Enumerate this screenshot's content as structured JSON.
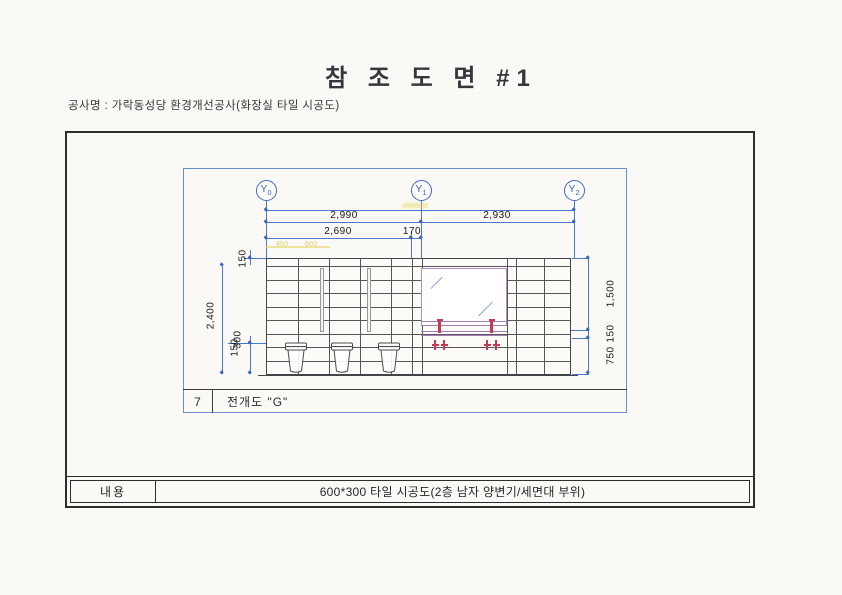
{
  "header": {
    "title": "참 조 도 면 #1",
    "project": "공사명 : 가락동성당 환경개선공사(화장실 타일 시공도)"
  },
  "drawing": {
    "markers": [
      {
        "base": "Y",
        "sub": "0"
      },
      {
        "base": "Y",
        "sub": "1"
      },
      {
        "base": "Y",
        "sub": "2"
      }
    ],
    "dims": {
      "span_left": "2,990",
      "span_right": "2,930",
      "sub_span": "2,690",
      "wall_thickness": "170",
      "left_top": "150",
      "left_height": "2,400",
      "left_bottom_upper": "300",
      "left_bottom_lower": "150",
      "right_upper": "1,500",
      "right_mid": "150",
      "right_lower": "750",
      "pencil_left": "450",
      "pencil_right": "600"
    },
    "title_block": {
      "number": "7",
      "label": "전개도 \"G\""
    }
  },
  "footer": {
    "label": "내용",
    "content": "600*300 타일 시공도(2층 남자 양변기/세면대 부위)"
  },
  "colors": {
    "dim_blue": "#4a79c9",
    "line_dark": "#43444a",
    "accent_red": "#c53a55",
    "mirror_purple": "#b78ec4",
    "pencil_yellow": "#d9c755",
    "frame_black": "#2c2d31"
  }
}
